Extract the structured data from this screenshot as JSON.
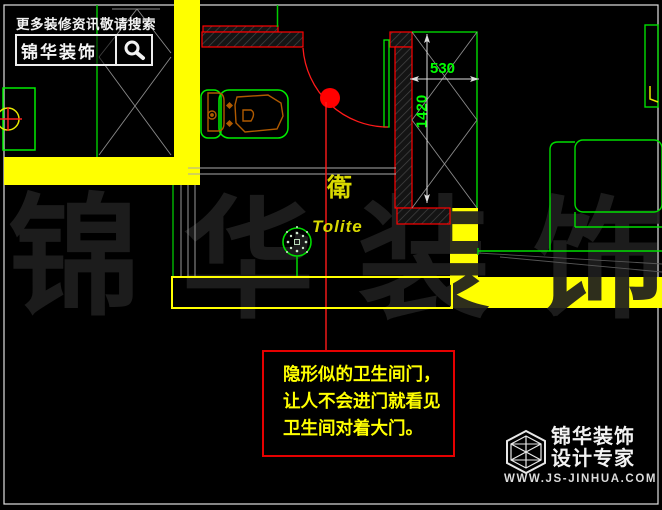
{
  "header": {
    "tagline": "更多装修资讯敬请搜索",
    "brand": "锦华装饰"
  },
  "plan": {
    "room_label": "衛",
    "room_label_en": "Tolite",
    "dim_width": "530",
    "dim_height": "1420"
  },
  "annotation": {
    "line1": "隐形似的卫生间门，",
    "line2": "让人不会进门就看见",
    "line3": "卫生间对着大门。"
  },
  "watermark": {
    "chars": [
      "锦",
      "华",
      "装",
      "饰"
    ]
  },
  "footer": {
    "brand": "锦华装饰",
    "subtitle": "设计专家",
    "website": "WWW.JS-JINHUA.COM"
  },
  "icons": {
    "search": "magnifier-in-box",
    "footer_logo": "wireframe-cube-hexagon"
  },
  "colors": {
    "background": "#000000",
    "wall_yellow": "#ffff00",
    "cad_green": "#00ff00",
    "cad_red": "#ff0000",
    "fixture_orange": "#b05a00",
    "dim_text_green": "#00ff00",
    "annotation_yellow": "#ffff00",
    "text_white": "#f2f2f2"
  }
}
